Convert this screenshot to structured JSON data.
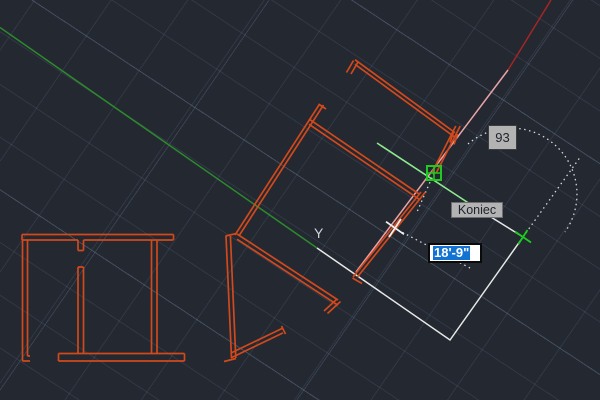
{
  "viewport": {
    "axis_label_y": "Y",
    "angle_tooltip": {
      "value": "93"
    },
    "osnap_tooltip": {
      "label": "Koniec"
    },
    "dynamic_input": {
      "value": "18'-9\"",
      "selected": true
    },
    "icons": {
      "snap_marker": "endpoint-snap-marker",
      "cursor": "rotated-crosshair-cursor",
      "tracking_point": "acquired-point-cross"
    },
    "colors": {
      "background": "#232831",
      "grid_line": "#39414f",
      "wall_orange": "#d2491c",
      "axis_green": "#2d8a2d",
      "axis_red": "#a42625",
      "tracking_pink": "#eba3a8",
      "drawn_line_white": "#e8e8e8",
      "rubber_band_green": "#8fe88f",
      "snap_green": "#1ecb1e",
      "selection_blue": "#1273d2",
      "tooltip_gray": "#b3b3b3"
    }
  }
}
